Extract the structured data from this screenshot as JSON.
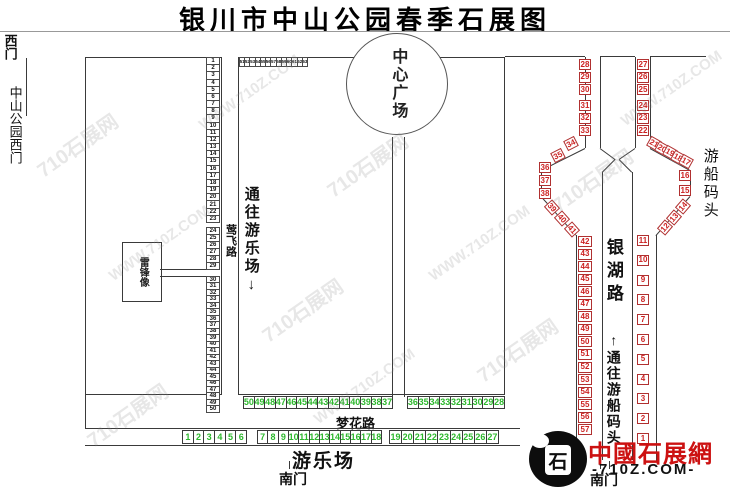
{
  "title": "银川市中山公园春季石展图",
  "watermark": {
    "cn": "710石展网",
    "en": "WWW.710Z.COM"
  },
  "gates": {
    "west": "西门",
    "west_full": "中山公园西门",
    "south_center": "南门",
    "south_east": "南门"
  },
  "landmarks": {
    "center_plaza": "中心广场",
    "leifeng_statue": "雷锋像",
    "amusement_park": "游乐场",
    "boat_dock": "游船码头"
  },
  "roads": {
    "yingfei": "莺飞路",
    "menghua": "梦花路",
    "yinhu": "银湖路"
  },
  "directions": {
    "to_amusement": "通往游乐场",
    "down_arrow": "↓",
    "to_boat_dock": "通往游船码头",
    "up_arrow": "↑"
  },
  "logo": {
    "seal_char": "石",
    "brand": "中國石展網",
    "domain": "710Z.COM"
  },
  "colors": {
    "black_stone": "#111111",
    "green_stone": "#2db82d",
    "red_stone": "#cc2222",
    "logo_red": "#cc1111"
  },
  "stones": {
    "black": {
      "column_upper": [
        1,
        2,
        3,
        4,
        5,
        6,
        7,
        8,
        9,
        10,
        11,
        12,
        13,
        14,
        15,
        16,
        17,
        18,
        19,
        20,
        21,
        22,
        23
      ],
      "column_mid": [
        24,
        25,
        26,
        27,
        28,
        29
      ],
      "column_lower": [
        30,
        31,
        32,
        33,
        34,
        35,
        36,
        37,
        38,
        39,
        40,
        41,
        42,
        43,
        44,
        45,
        46,
        47,
        48,
        49,
        50
      ],
      "top_row": [
        51,
        52,
        53,
        54,
        55,
        56,
        57,
        58,
        59,
        60,
        61,
        62,
        63
      ]
    },
    "green": {
      "row_a_left": [
        50,
        49,
        48,
        47,
        46,
        45,
        44,
        43,
        42,
        41,
        40,
        39,
        38,
        37
      ],
      "row_a_right": [
        36,
        35,
        34,
        33,
        32,
        31,
        30,
        29,
        28
      ],
      "row_b_1": [
        1,
        2,
        3,
        4,
        5,
        6
      ],
      "row_b_2": [
        7,
        8,
        9,
        10,
        11,
        12,
        13,
        14,
        15,
        16,
        17,
        18
      ],
      "row_b_3": [
        19,
        20,
        21,
        22,
        23,
        24,
        25,
        26,
        27
      ]
    },
    "red": {
      "road1_a": [
        28,
        29,
        30
      ],
      "road1_b": [
        31,
        32,
        33
      ],
      "diag_tl": [
        34,
        35
      ],
      "edge_left": [
        36,
        37,
        38
      ],
      "diag_bl": [
        39,
        40,
        41
      ],
      "lane_left": [
        42,
        43,
        44,
        45,
        46,
        47,
        48,
        49,
        50,
        51,
        52,
        53,
        54,
        55,
        56,
        57
      ],
      "road2_a": [
        27,
        26
      ],
      "road2_b": [
        25
      ],
      "road2_c": [
        24,
        23,
        22
      ],
      "diag_tr": [
        21,
        20,
        19,
        18,
        17
      ],
      "edge_right": [
        16,
        15
      ],
      "diag_br": [
        14,
        13,
        12
      ],
      "lane_right": [
        11,
        10,
        9,
        8,
        7,
        6,
        5,
        4,
        3,
        2,
        1
      ]
    }
  }
}
